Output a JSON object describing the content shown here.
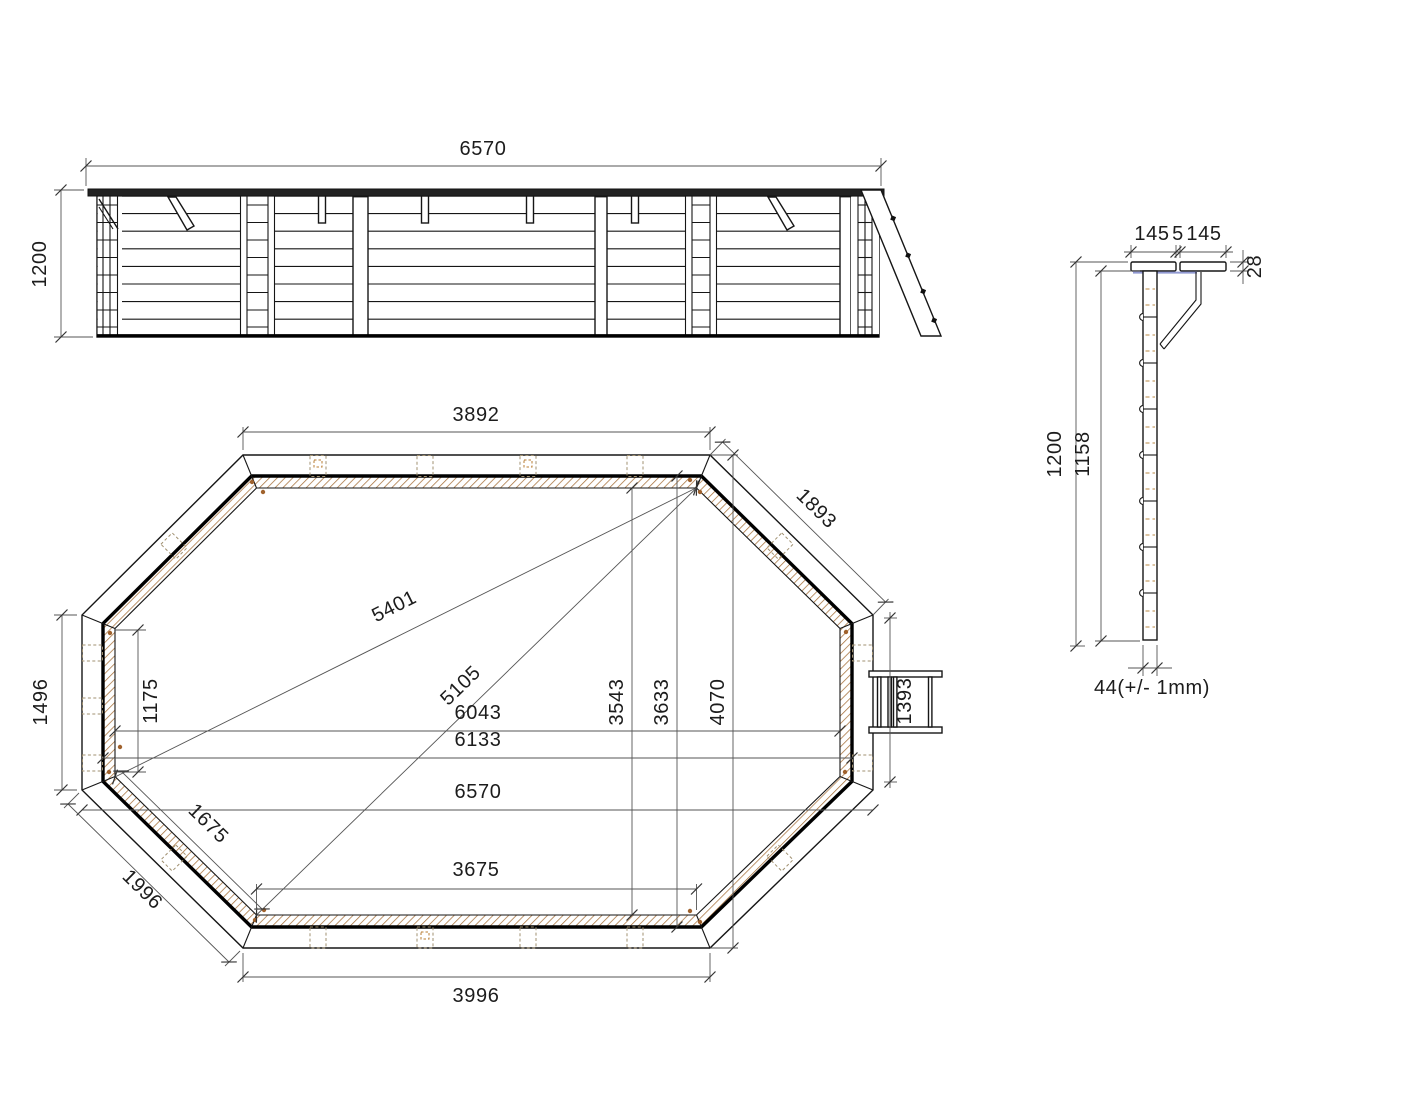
{
  "labels": {
    "elevation": {
      "width": "6570",
      "height": "1200"
    },
    "plan": {
      "top_width": "3892",
      "top_right_edge": "1893",
      "diagonal_long": "5401",
      "diagonal_short": "5105",
      "inner_width": "6043",
      "mid_width": "6133",
      "overall_width": "6570",
      "left_edge": "1496",
      "left_inner_edge": "1175",
      "bottom_left_inner_edge": "1675",
      "bottom_left_edge": "1996",
      "bottom_inner_width": "3675",
      "bottom_outer_width": "3996",
      "inner_height": "3543",
      "mid_height": "3633",
      "overall_height": "4070",
      "ladder_length": "1393"
    },
    "section": {
      "cap_left": "145",
      "cap_gap": "5",
      "cap_right": "145",
      "cap_thickness": "28",
      "height": "1200",
      "inner_height": "1158",
      "plank_width": "44(+/- 1mm)"
    }
  },
  "colors": {
    "linework": "#161616",
    "hatch": "#a5703a",
    "wood_dash": "#c8a06a",
    "water_line": "#7e88cb"
  }
}
